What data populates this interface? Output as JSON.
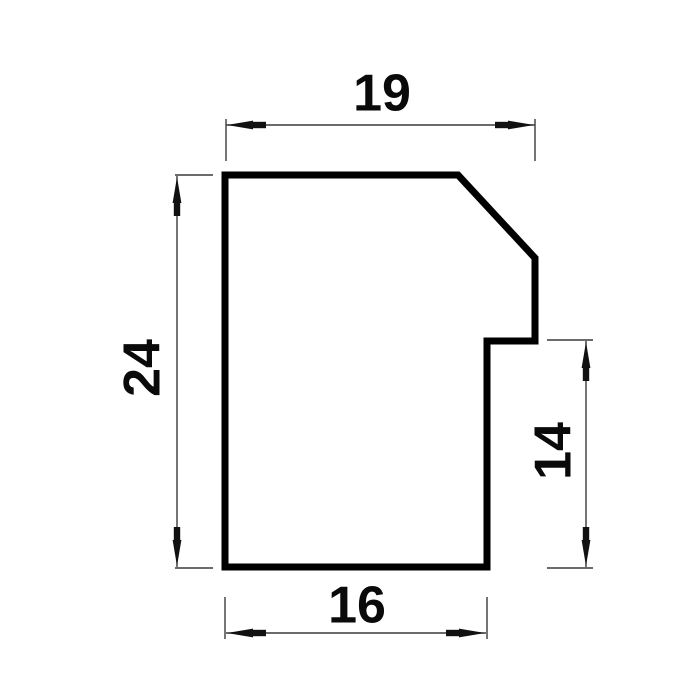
{
  "colors": {
    "background": "#ffffff",
    "profile_outline": "#000000",
    "dimension_line": "#3a3a3a",
    "arrow_fill": "#111111",
    "label_text": "#0a0a0a"
  },
  "dimensions": {
    "top_width": {
      "label": "19"
    },
    "left_height": {
      "label": "24"
    },
    "right_height": {
      "label": "14"
    },
    "bottom_width": {
      "label": "16"
    }
  }
}
